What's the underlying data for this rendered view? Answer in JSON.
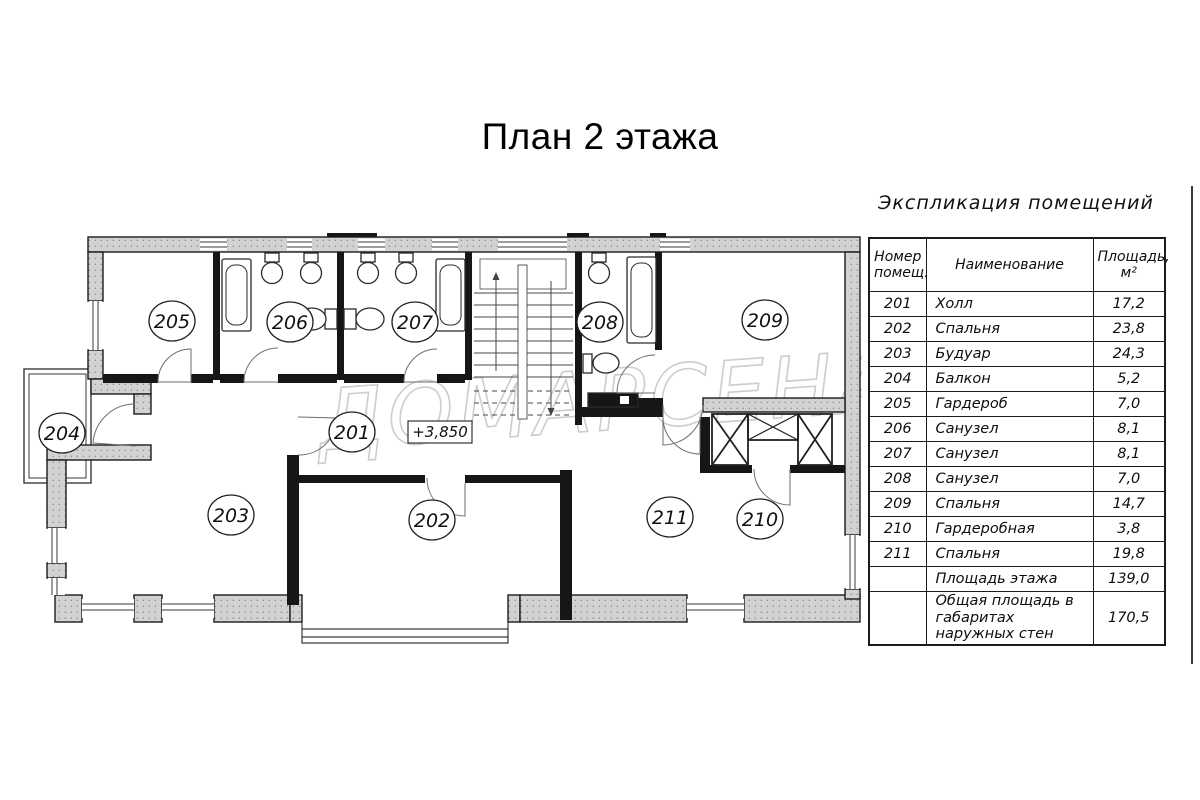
{
  "title": "План 2 этажа",
  "plan": {
    "elevation_mark": "+3,850",
    "watermark": "ДОМАРСЕНАЛ"
  },
  "legend": {
    "title": "Экспликация помещений",
    "columns": [
      "Номер помещ.",
      "Наименование",
      "Площадь, м²"
    ],
    "rows": [
      {
        "number": "201",
        "name": "Холл",
        "area": "17,2"
      },
      {
        "number": "202",
        "name": "Спальня",
        "area": "23,8"
      },
      {
        "number": "203",
        "name": "Будуар",
        "area": "24,3"
      },
      {
        "number": "204",
        "name": "Балкон",
        "area": "5,2"
      },
      {
        "number": "205",
        "name": "Гардероб",
        "area": "7,0"
      },
      {
        "number": "206",
        "name": "Санузел",
        "area": "8,1"
      },
      {
        "number": "207",
        "name": "Санузел",
        "area": "8,1"
      },
      {
        "number": "208",
        "name": "Санузел",
        "area": "7,0"
      },
      {
        "number": "209",
        "name": "Спальня",
        "area": "14,7"
      },
      {
        "number": "210",
        "name": "Гардеробная",
        "area": "3,8"
      },
      {
        "number": "211",
        "name": "Спальня",
        "area": "19,8"
      }
    ],
    "summary": [
      {
        "number": "",
        "name": "Площадь этажа",
        "area": "139,0"
      },
      {
        "number": "",
        "name": "Общая площадь в габаритах наружных стен",
        "area": "170,5"
      }
    ]
  }
}
